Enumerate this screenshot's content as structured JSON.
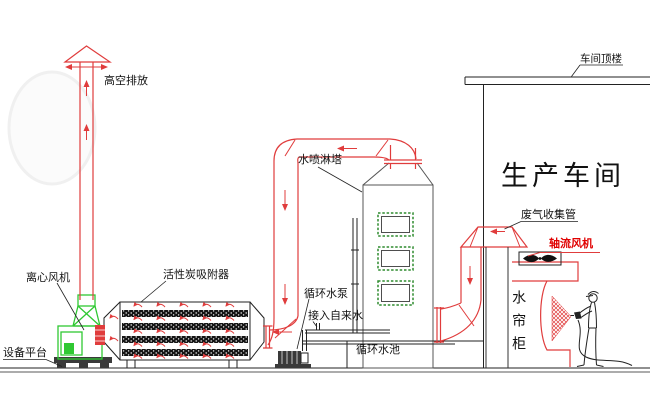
{
  "colors": {
    "pipe_red": "#e03c3c",
    "label_red": "#e00000",
    "fan_green": "#2fc832",
    "window_green": "#2e8b2e",
    "tower_gray": "#555555",
    "ink": "#222222"
  },
  "labels": {
    "high_discharge": "高空排放",
    "centrifugal_fan": "离心风机",
    "equipment_platform": "设备平台",
    "carbon_adsorber": "活性炭吸附器",
    "spray_tower": "水喷淋塔",
    "circulating_pump": "循环水泵",
    "tap_water": "接入自来水",
    "circulating_pool": "循环水池",
    "workshop": "生产车间",
    "workshop_roof": "车间顶楼",
    "gas_collection_pipe": "废气收集管",
    "axial_fan": "轴流风机",
    "water_curtain": "水帘柜"
  }
}
